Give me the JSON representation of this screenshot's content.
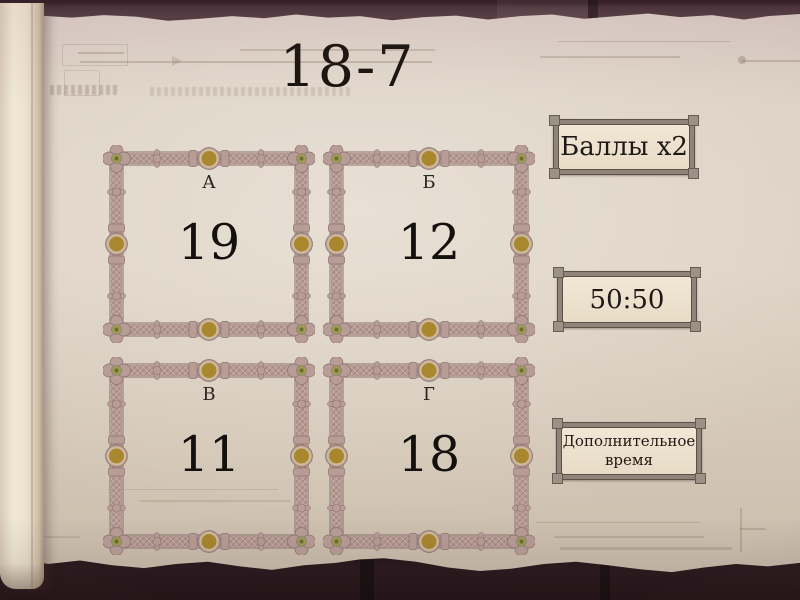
{
  "title": "18-7",
  "answers": [
    {
      "letter": "А",
      "value": "19"
    },
    {
      "letter": "Б",
      "value": "12"
    },
    {
      "letter": "В",
      "value": "11"
    },
    {
      "letter": "Г",
      "value": "18"
    }
  ],
  "lifelines": [
    {
      "label": "Баллы x2"
    },
    {
      "label": "50:50"
    },
    {
      "label": "Дополнительное время"
    }
  ],
  "colors": {
    "parchment": "#dbd0c3",
    "frame_mauve": "#b79d96",
    "frame_outline": "#8d7370",
    "medallion_gold": "#a8872f",
    "corner_olive": "#9c9c55",
    "dark_band": "#2a191e",
    "button_frame": "#8e847a",
    "button_fill": "#ece1cf",
    "text": "#18130f"
  }
}
